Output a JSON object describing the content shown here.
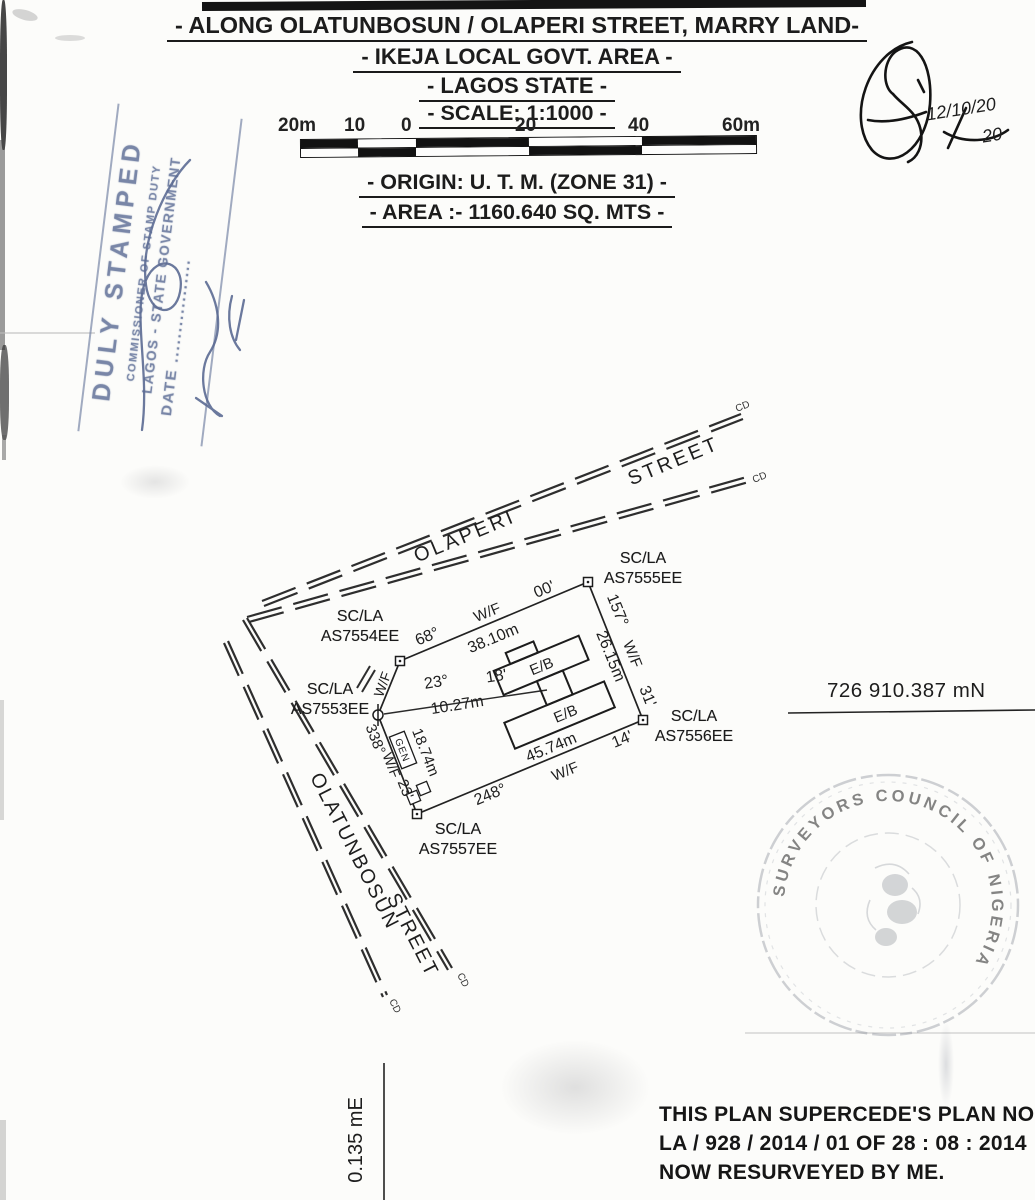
{
  "header": {
    "title1": "- ALONG OLATUNBOSUN / OLAPERI STREET, MARRY LAND-",
    "title2": "- IKEJA LOCAL GOVT. AREA -",
    "title3": "- LAGOS STATE -",
    "scale_line": "- SCALE: 1:1000 -",
    "origin_line": "- ORIGIN: U. T. M. (ZONE 31) -",
    "area_line": "- AREA :- 1160.640 SQ. MTS -"
  },
  "scale_bar": {
    "labels": [
      "20m",
      "10",
      "0",
      "20",
      "40",
      "60m"
    ]
  },
  "stamp": {
    "line1": "DULY STAMPED",
    "line2": "COMMISSIONER OF STAMP DUTY",
    "line3": "LAGOS - STATE GOVERNMENT",
    "line4": "DATE .................",
    "ink_color": "#6e7da1"
  },
  "signature": {
    "date_main": "12/10/20",
    "date_sub": "20"
  },
  "plan": {
    "streets": {
      "olaperi": {
        "word1": "OLAPERI",
        "word2": "STREET"
      },
      "olatunbosun": {
        "word1": "OLATUNBOSUN",
        "word2": "STREET"
      }
    },
    "end_mark": "CD",
    "beacons": [
      {
        "line1": "SC/LA",
        "line2": "AS7554EE"
      },
      {
        "line1": "SC/LA",
        "line2": "AS7555EE"
      },
      {
        "line1": "SC/LA",
        "line2": "AS7556EE"
      },
      {
        "line1": "SC/LA",
        "line2": "AS7557EE"
      },
      {
        "line1": "SC/LA",
        "line2": "AS7553EE"
      }
    ],
    "edges": {
      "top": {
        "bearing": "68°",
        "wf": "W/F",
        "minutes": "00'",
        "distance": "38.10m"
      },
      "right": {
        "bearing": "157°",
        "wf": "W/F",
        "minutes": "31'",
        "distance": "26.15m"
      },
      "bottom": {
        "bearing": "248°",
        "wf": "W/F",
        "minutes": "14'",
        "distance": "45.74m"
      },
      "west": {
        "bearing": "338°",
        "wf": "W/F",
        "minutes": "23'",
        "distance": "18.74m"
      },
      "cross": {
        "bearing": "23°",
        "wf": "W/F",
        "minutes": "18'",
        "distance": "10.27m"
      }
    },
    "building_label": "E/B",
    "gen_label": "GEN",
    "grid_north": "726 910.387 mN",
    "grid_east": "0.135 mE"
  },
  "seal": {
    "ring_text": "SURVEYORS COUNCIL OF NIGERIA"
  },
  "footer": {
    "line1": "THIS PLAN SUPERCEDE'S PLAN NO",
    "line2": "LA / 928 / 2014 / 01 OF 28 : 08 : 2014",
    "line3": "NOW RESURVEYED BY ME."
  }
}
